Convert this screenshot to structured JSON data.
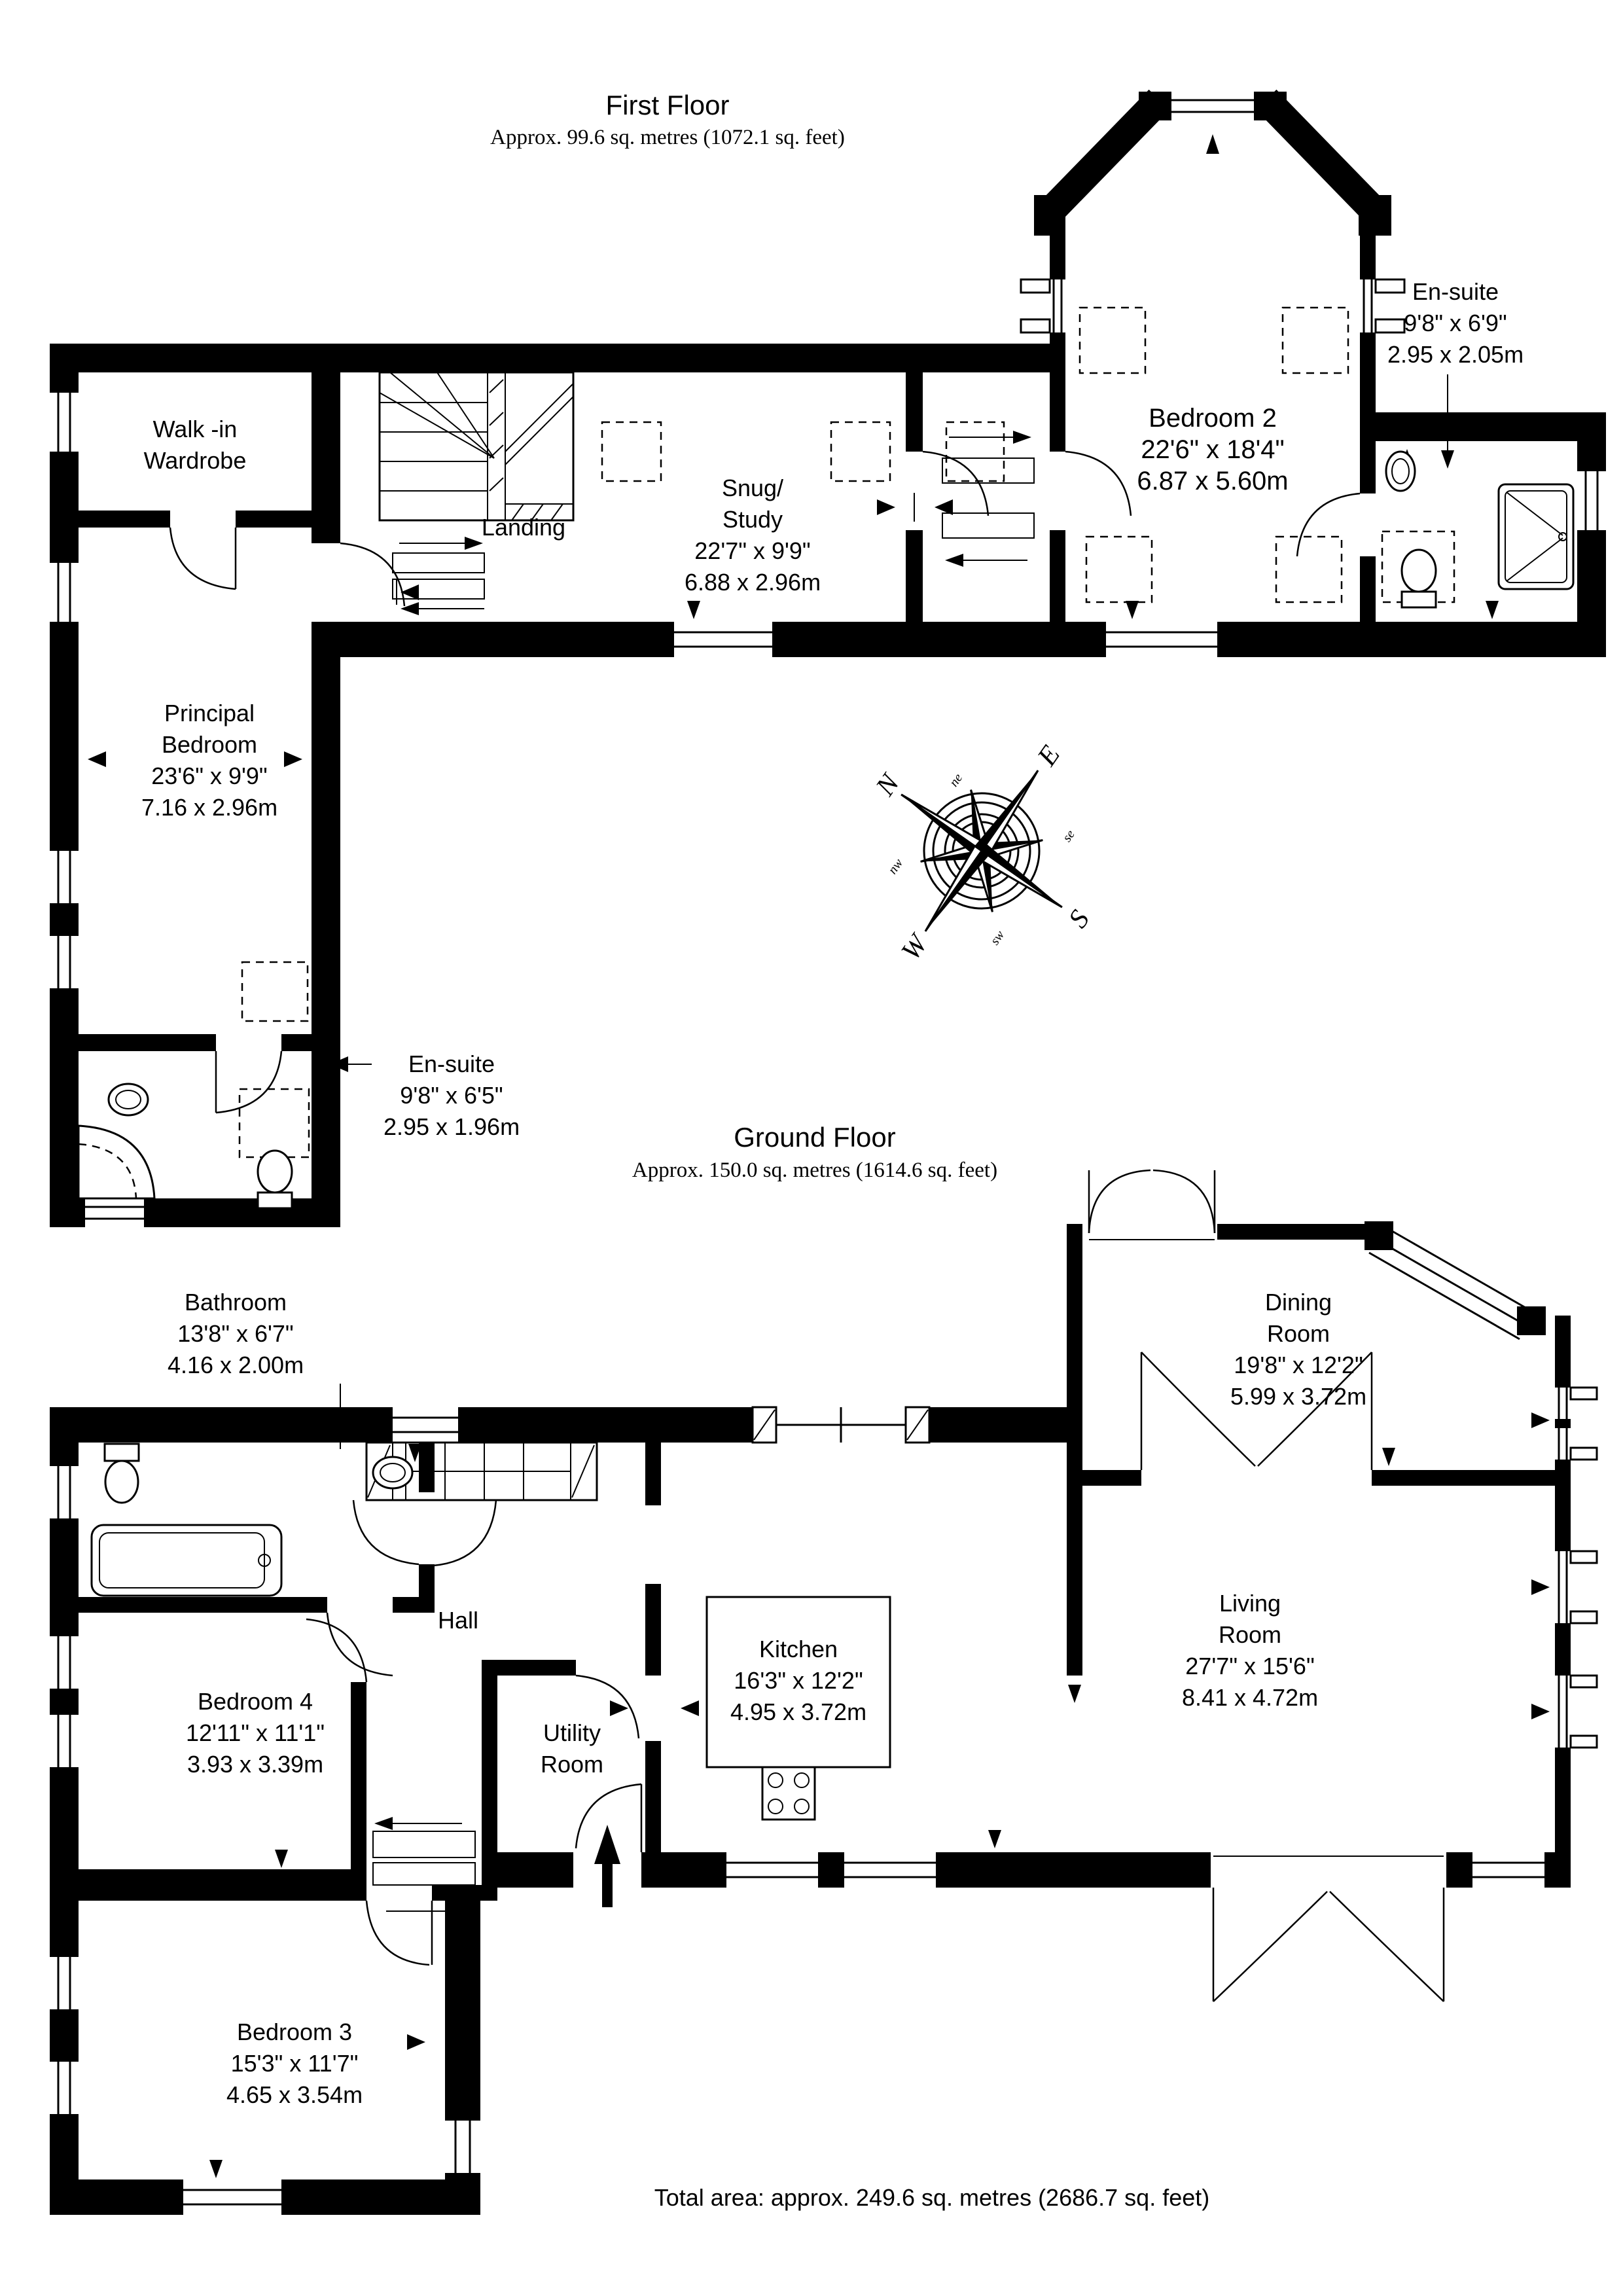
{
  "first_floor": {
    "title": "First Floor",
    "area": "Approx. 99.6 sq. metres (1072.1 sq. feet)",
    "rooms": {
      "walk_in_wardrobe": {
        "name1": "Walk -in",
        "name2": "Wardrobe"
      },
      "landing": {
        "name": "Landing"
      },
      "snug_study": {
        "name1": "Snug/",
        "name2": "Study",
        "dims_ft": "22'7\" x 9'9\"",
        "dims_m": "6.88 x 2.96m"
      },
      "bedroom2": {
        "name": "Bedroom 2",
        "dims_ft": "22'6\" x 18'4\"",
        "dims_m": "6.87 x 5.60m"
      },
      "ensuite_bedroom2": {
        "name": "En-suite",
        "dims_ft": "9'8\" x 6'9\"",
        "dims_m": "2.95 x 2.05m"
      },
      "principal_bedroom": {
        "name1": "Principal",
        "name2": "Bedroom",
        "dims_ft": "23'6\" x 9'9\"",
        "dims_m": "7.16 x 2.96m"
      },
      "ensuite_principal": {
        "name": "En-suite",
        "dims_ft": "9'8\" x 6'5\"",
        "dims_m": "2.95 x 1.96m"
      }
    }
  },
  "ground_floor": {
    "title": "Ground Floor",
    "area": "Approx. 150.0 sq. metres (1614.6 sq. feet)",
    "rooms": {
      "bathroom": {
        "name": "Bathroom",
        "dims_ft": "13'8\" x 6'7\"",
        "dims_m": "4.16 x 2.00m"
      },
      "hall": {
        "name": "Hall"
      },
      "bedroom4": {
        "name": "Bedroom 4",
        "dims_ft": "12'11\" x 11'1\"",
        "dims_m": "3.93 x 3.39m"
      },
      "utility": {
        "name1": "Utility",
        "name2": "Room"
      },
      "kitchen": {
        "name": "Kitchen",
        "dims_ft": "16'3\" x 12'2\"",
        "dims_m": "4.95 x 3.72m"
      },
      "living": {
        "name1": "Living",
        "name2": "Room",
        "dims_ft": "27'7\" x 15'6\"",
        "dims_m": "8.41 x 4.72m"
      },
      "dining": {
        "name1": "Dining",
        "name2": "Room",
        "dims_ft": "19'8\" x 12'2\"",
        "dims_m": "5.99 x 3.72m"
      },
      "bedroom3": {
        "name": "Bedroom 3",
        "dims_ft": "15'3\" x 11'7\"",
        "dims_m": "4.65 x 3.54m"
      }
    }
  },
  "compass": {
    "n": "N",
    "e": "E",
    "s": "S",
    "w": "W",
    "ne": "ne",
    "se": "se",
    "sw": "sw",
    "nw": "nw"
  },
  "footer": {
    "total_area": "Total area: approx. 249.6 sq. metres (2686.7 sq. feet)"
  }
}
